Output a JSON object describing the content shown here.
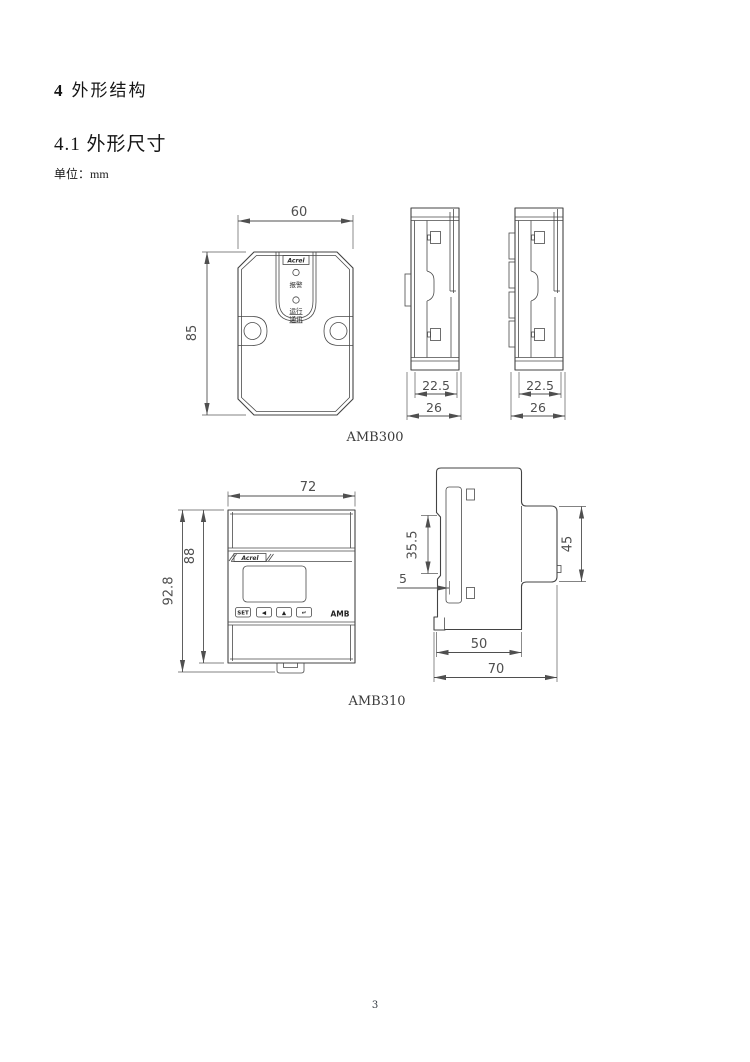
{
  "document": {
    "heading_number": "4",
    "heading_title": "外形结构",
    "subheading": "4.1 外形尺寸",
    "unit_note": "单位：mm",
    "page_number": "3"
  },
  "amb300": {
    "model_label": "AMB300",
    "logo_text": "Acrel",
    "led_alarm_label": "报警",
    "led_run_label": "运行",
    "led_comm_label": "通讯",
    "dims": {
      "front_width": "60",
      "front_height": "85",
      "side_inner_width": "22.5",
      "side_outer_width": "26"
    }
  },
  "amb310": {
    "model_label": "AMB310",
    "logo_text": "Acrel",
    "display_model_text": "AMB",
    "buttons": [
      "SET",
      "◀",
      "▲",
      "↵"
    ],
    "dims": {
      "front_width": "72",
      "front_height_total": "92.8",
      "front_height_body": "88",
      "side_slot_height": "35.5",
      "side_offset": "5",
      "side_protrusion_height": "45",
      "side_body_depth": "50",
      "side_total_depth": "70"
    }
  }
}
